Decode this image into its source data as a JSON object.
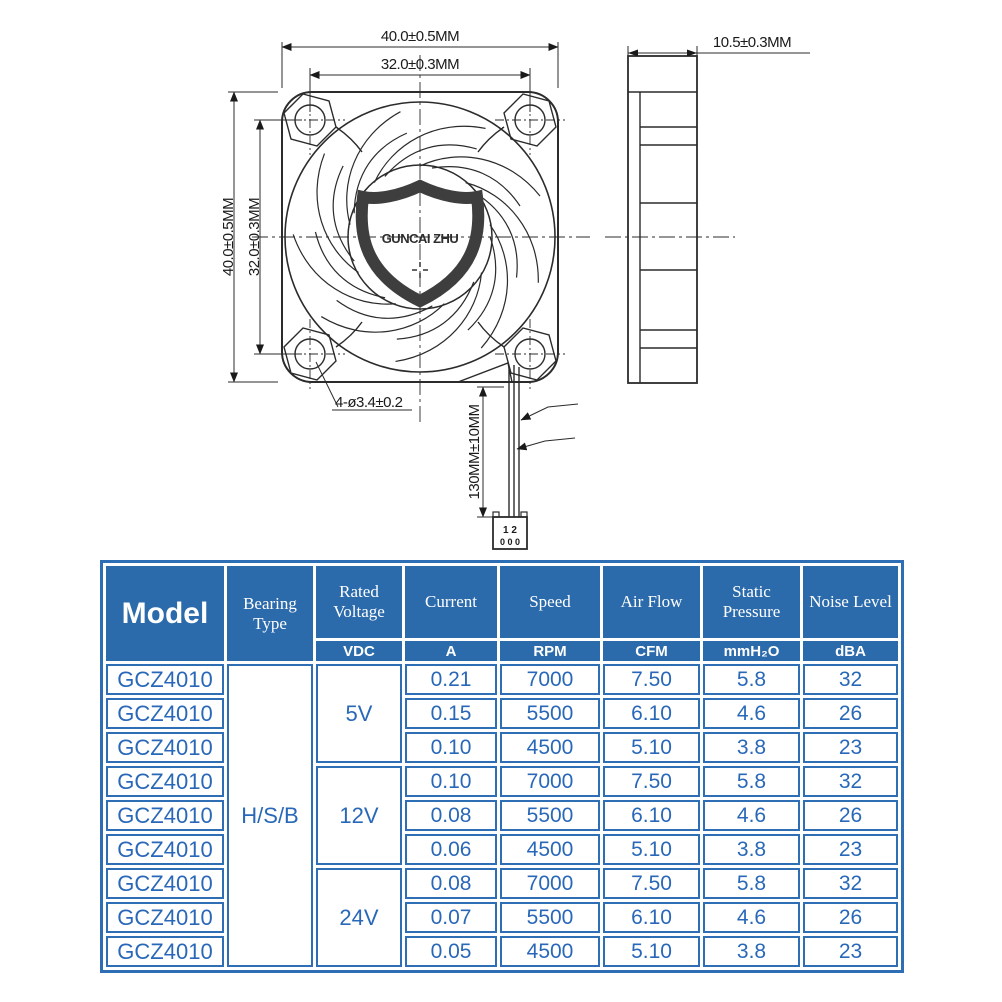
{
  "drawing": {
    "logo_text": "GUNCAI ZHU",
    "dim_width_top": "40.0±0.5MM",
    "dim_pitch_top": "32.0±0.3MM",
    "dim_width_left": "40.0±0.5MM",
    "dim_pitch_left": "32.0±0.3MM",
    "dim_thickness": "10.5±0.3MM",
    "dim_mount_holes": "4-ø3.4±0.2",
    "dim_cable_length": "130MM±10MM",
    "connector_row1": "1 2",
    "connector_row2": "0 0 0"
  },
  "table": {
    "header": {
      "model": "Model",
      "bearing": "Bearing Type",
      "voltage": "Rated Voltage",
      "current": "Current",
      "speed": "Speed",
      "airflow": "Air Flow",
      "pressure": "Static Pressure",
      "noise": "Noise Level"
    },
    "units": {
      "voltage": "VDC",
      "current": "A",
      "speed": "RPM",
      "airflow": "CFM",
      "pressure": "mmH₂O",
      "noise": "dBA"
    },
    "bearing_type": "H/S/B",
    "colors": {
      "header_bg": "#2b6aab",
      "border": "#2e6eb5",
      "text": "#2968b8"
    },
    "groups": [
      {
        "voltage": "5V",
        "rows": [
          {
            "model": "GCZ4010",
            "current": "0.21",
            "speed": "7000",
            "airflow": "7.50",
            "pressure": "5.8",
            "noise": "32"
          },
          {
            "model": "GCZ4010",
            "current": "0.15",
            "speed": "5500",
            "airflow": "6.10",
            "pressure": "4.6",
            "noise": "26"
          },
          {
            "model": "GCZ4010",
            "current": "0.10",
            "speed": "4500",
            "airflow": "5.10",
            "pressure": "3.8",
            "noise": "23"
          }
        ]
      },
      {
        "voltage": "12V",
        "rows": [
          {
            "model": "GCZ4010",
            "current": "0.10",
            "speed": "7000",
            "airflow": "7.50",
            "pressure": "5.8",
            "noise": "32"
          },
          {
            "model": "GCZ4010",
            "current": "0.08",
            "speed": "5500",
            "airflow": "6.10",
            "pressure": "4.6",
            "noise": "26"
          },
          {
            "model": "GCZ4010",
            "current": "0.06",
            "speed": "4500",
            "airflow": "5.10",
            "pressure": "3.8",
            "noise": "23"
          }
        ]
      },
      {
        "voltage": "24V",
        "rows": [
          {
            "model": "GCZ4010",
            "current": "0.08",
            "speed": "7000",
            "airflow": "7.50",
            "pressure": "5.8",
            "noise": "32"
          },
          {
            "model": "GCZ4010",
            "current": "0.07",
            "speed": "5500",
            "airflow": "6.10",
            "pressure": "4.6",
            "noise": "26"
          },
          {
            "model": "GCZ4010",
            "current": "0.05",
            "speed": "4500",
            "airflow": "5.10",
            "pressure": "3.8",
            "noise": "23"
          }
        ]
      }
    ]
  }
}
